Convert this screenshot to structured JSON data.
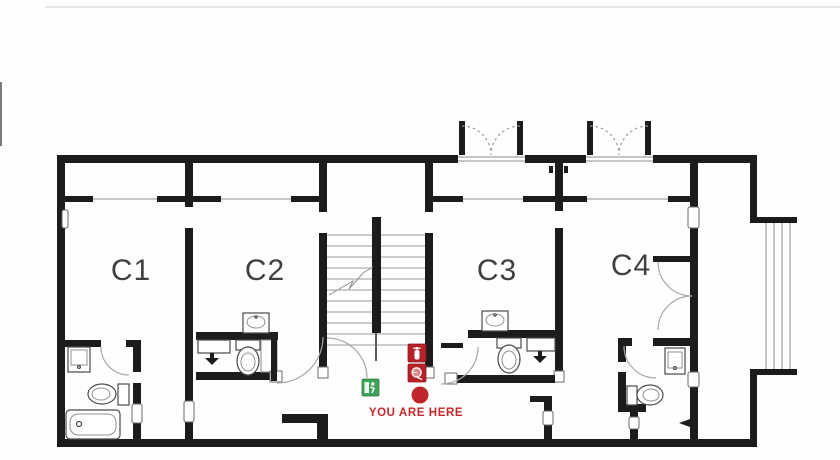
{
  "plan": {
    "title": "evacuation-floor-plan",
    "rooms": [
      {
        "id": "c1",
        "label": "C1"
      },
      {
        "id": "c2",
        "label": "C2"
      },
      {
        "id": "c3",
        "label": "C3"
      },
      {
        "id": "c4",
        "label": "C4"
      }
    ],
    "marker": {
      "label": "YOU ARE HERE"
    },
    "icons": [
      {
        "name": "emergency-exit-icon",
        "color": "#3da35a"
      },
      {
        "name": "fire-extinguisher-icon",
        "color": "#b62227"
      },
      {
        "name": "fire-hose-reel-icon",
        "color": "#b62227"
      },
      {
        "name": "you-are-here-dot",
        "color": "#c0272d"
      }
    ],
    "colors": {
      "wall": "#1c1c1c",
      "thin_line": "#8f8f8f",
      "door_arc": "#a8a8a8",
      "label": "#3f3f3f",
      "marker_red": "#c0272d",
      "exit_green": "#3da35a"
    }
  }
}
